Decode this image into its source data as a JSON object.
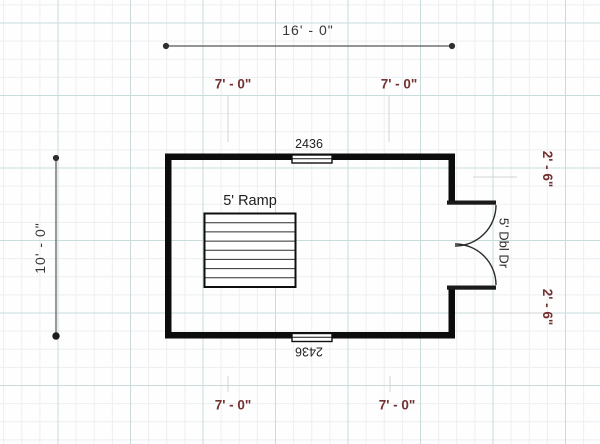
{
  "canvas": {
    "background": "#fefefe",
    "grid_major_color": "#c9dcdc",
    "grid_minor_color": "#eceff1"
  },
  "colors": {
    "wall": "#0c0c0c",
    "dimension_text": "#383838",
    "offset_text": "#743131",
    "dimension_line": "#565656",
    "witness_line": "#d4d4d4"
  },
  "dimensions": {
    "overall_width": "16' - 0\"",
    "overall_height": "10' - 0\"",
    "top_left_offset": "7' - 0\"",
    "top_right_offset": "7' - 0\"",
    "bottom_left_offset": "7' - 0\"",
    "bottom_right_offset": "7' - 0\"",
    "door_top_offset": "2' - 6\"",
    "door_bottom_offset": "2' - 6\""
  },
  "labels": {
    "ramp": "5' Ramp",
    "door": "5' Dbl Dr",
    "window_top": "2436",
    "window_bottom": "2436"
  }
}
